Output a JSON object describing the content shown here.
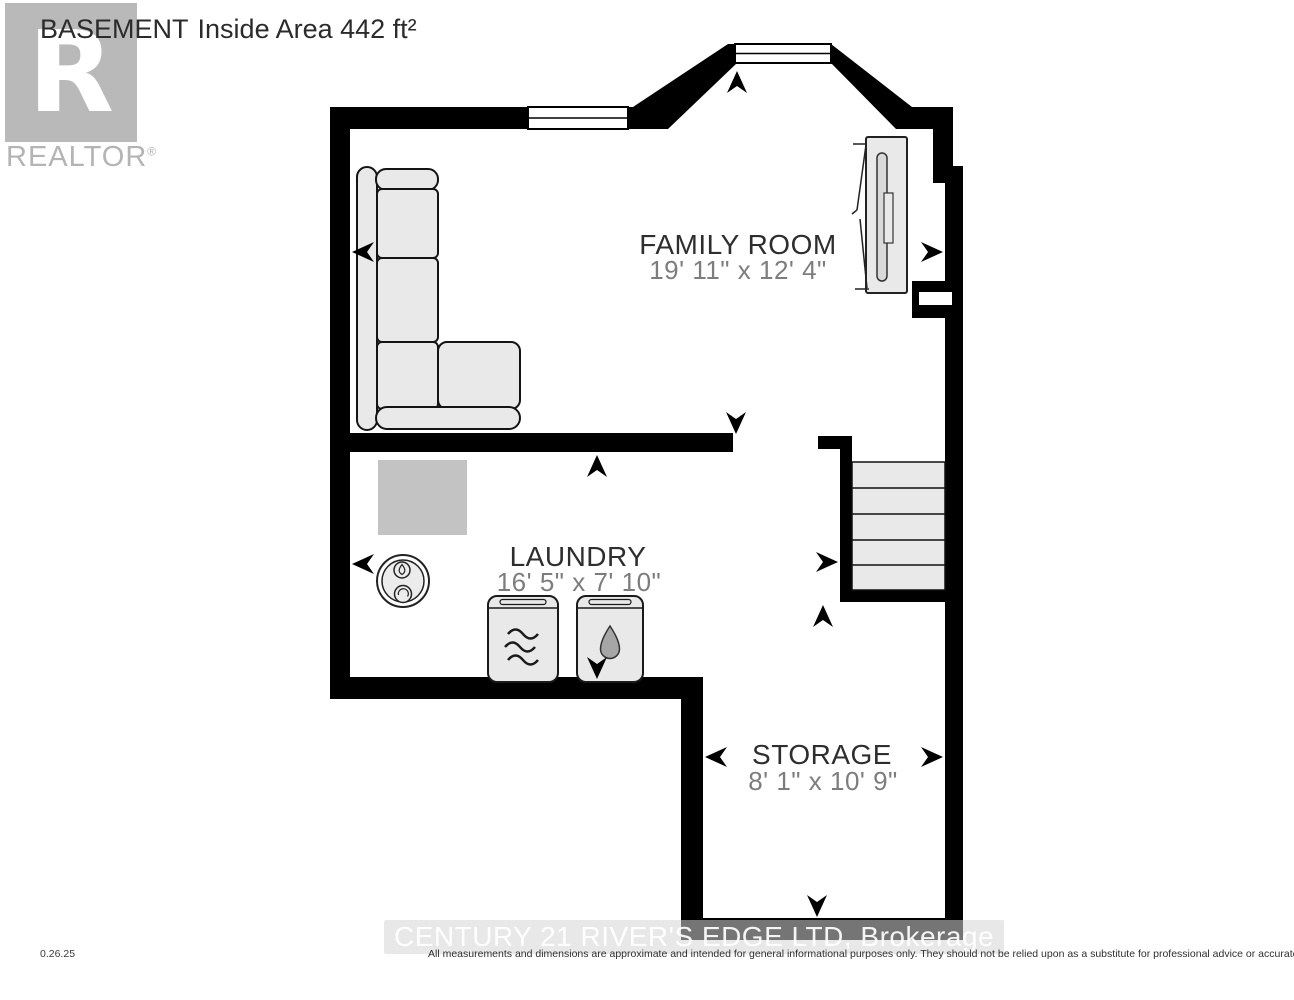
{
  "header": {
    "title": "BASEMENT",
    "area_label": "Inside Area 442 ft²"
  },
  "branding": {
    "logo_letter": "R",
    "logo_name": "REALTOR",
    "registered_mark": "®"
  },
  "rooms": [
    {
      "name": "FAMILY ROOM",
      "dimensions": "19' 11\" x 12' 4\""
    },
    {
      "name": "LAUNDRY",
      "dimensions": "16' 5\" x 7' 10\""
    },
    {
      "name": "STORAGE",
      "dimensions": "8' 1\" x 10' 9\""
    }
  ],
  "fixtures": [
    "sectional-sofa",
    "fireplace-tv",
    "furnace",
    "water-heater",
    "washer",
    "dryer",
    "staircase",
    "window",
    "dimension-arrows"
  ],
  "watermark": {
    "brokerage": "CENTURY 21 RIVER'S EDGE LTD, Brokerage"
  },
  "footer": {
    "date": "0.26.25",
    "disclaimer": "All measurements and dimensions are approximate and intended for general informational purposes only. They should not be relied upon as a substitute for professional advice or accurate surveying."
  },
  "colors": {
    "wall": "#000000",
    "furniture_fill": "#e9e9e9",
    "equipment_fill": "#c3c3c3",
    "room_label": "#2e2e2e",
    "dimension_label": "#7d7d7d",
    "watermark_gray": "#b9b9b9"
  }
}
